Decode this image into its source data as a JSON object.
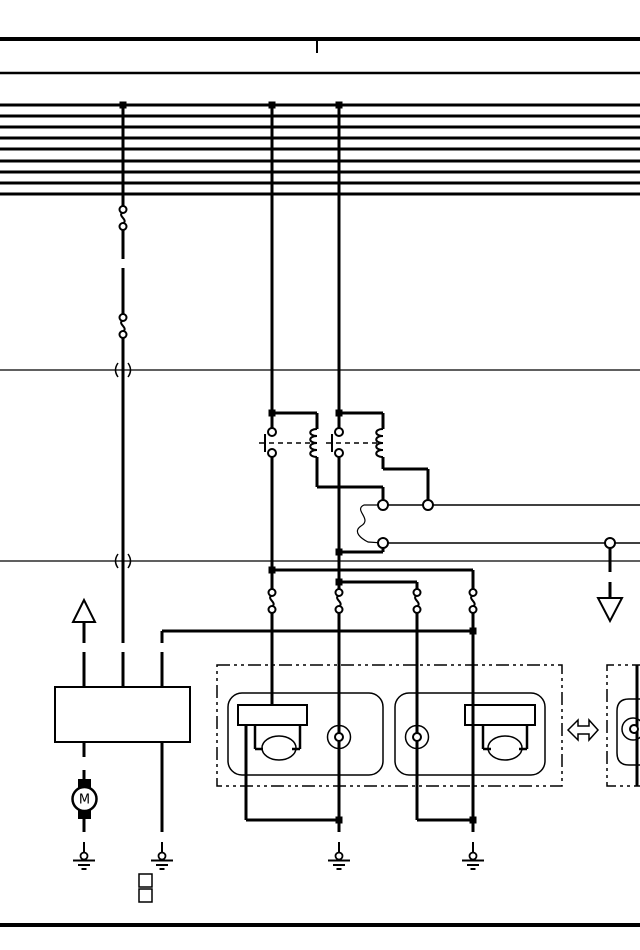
{
  "page": {
    "background_color": "#ffffff",
    "ink_color": "#000000"
  },
  "motor": {
    "label": "M"
  },
  "diagram": {
    "kind": "automotive-wiring-diagram",
    "bus_line_count": 9,
    "relay_count": 2,
    "ground_symbol_count": 4,
    "inline_connector_count": 6,
    "components": [
      "power-bus-lines",
      "relay-1",
      "relay-2",
      "headlamp-assembly-left",
      "marker-lamp-left",
      "marker-lamp-right",
      "headlamp-assembly-right",
      "far-right-lamp-assembly",
      "control-unit-box",
      "motor",
      "up-page-arrow",
      "down-page-arrow",
      "left-right-arrow"
    ]
  }
}
